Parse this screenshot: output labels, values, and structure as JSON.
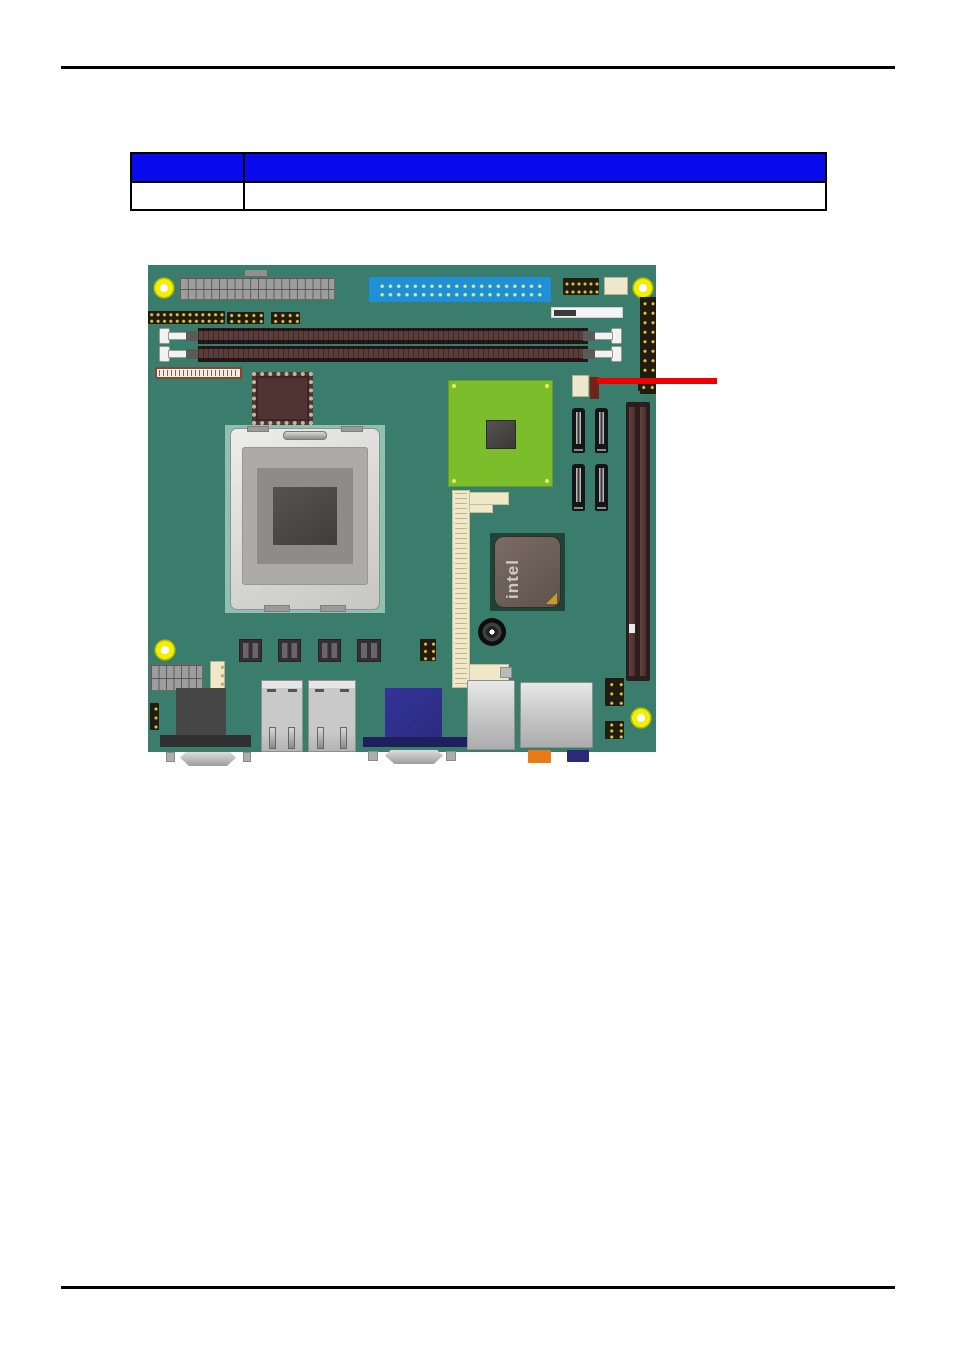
{
  "document": {
    "table": {
      "header_cells": [
        "",
        ""
      ],
      "body_cells": [
        "",
        ""
      ]
    }
  },
  "figure": {
    "type": "motherboard-diagram",
    "chip_label": "intel",
    "callout_line": {
      "color": "#EE0000"
    }
  },
  "colors": {
    "page-bg": "#FFFFFF",
    "rule": "#000000",
    "table-header": "#0A0AEE",
    "table-border": "#000000",
    "pcb": "#3A7D6C",
    "cpu-zone": "#8FC0B2",
    "heatsink": "#7CBD2B",
    "ide": "#1F8FD8",
    "dimm-dark": "#241718",
    "dimm-mid": "#5A3C3A",
    "slot-cream": "#F0E9C8",
    "chip-maroon": "#4F3433",
    "intel-pad": "#1E4436",
    "hole": "#F0F000",
    "header-dark": "#221C10",
    "dot-yellow": "#E0C040",
    "vga": "#2B2B7E",
    "jack-orange": "#E87A18",
    "jack-blue": "#2A2A78",
    "beige": "#EFE8CC",
    "jumper-red": "#6E2418",
    "callout": "#EE0000"
  }
}
